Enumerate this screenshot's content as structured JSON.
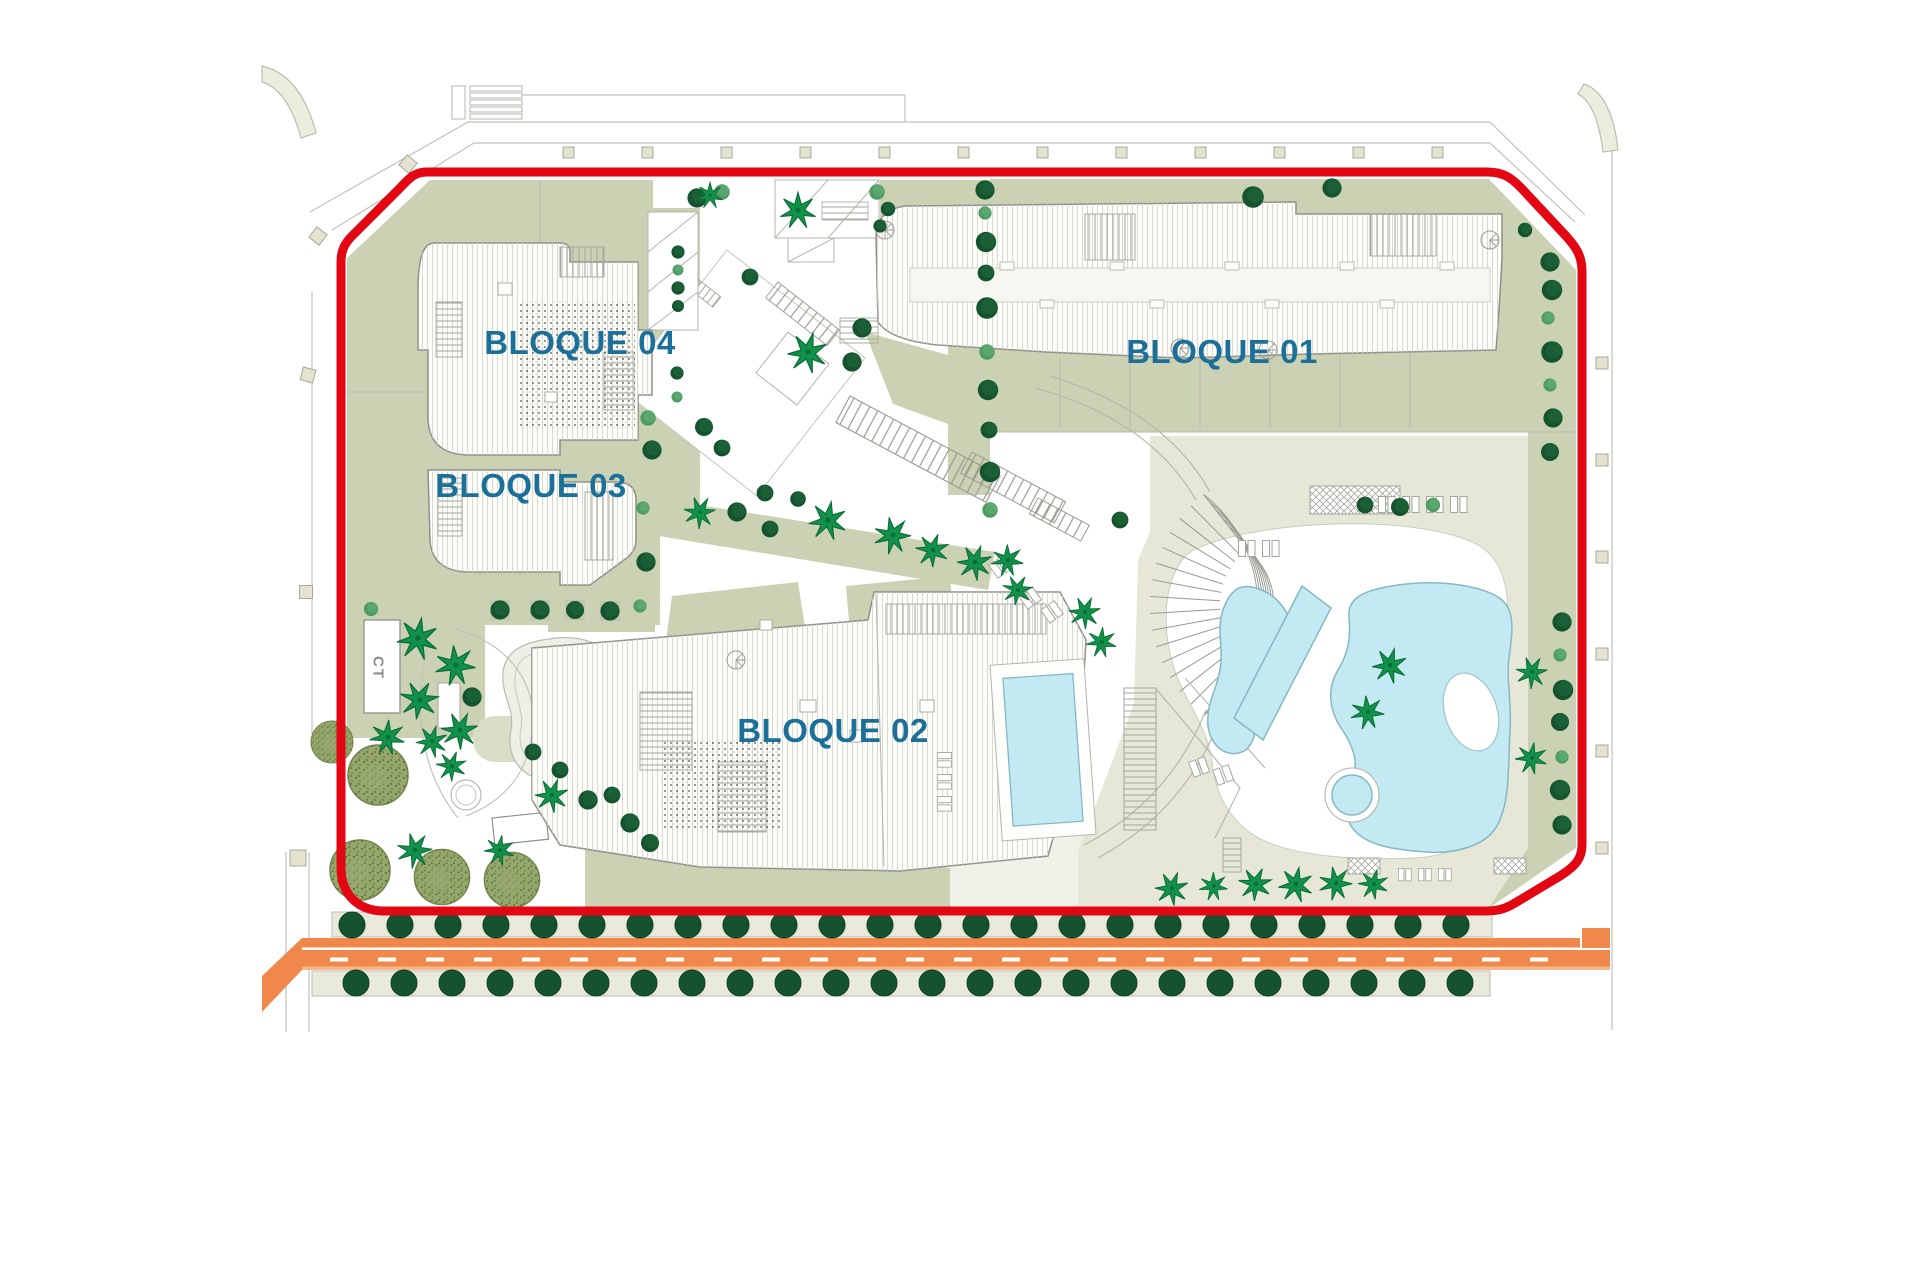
{
  "plan": {
    "block_labels": [
      "BLOQUE 01",
      "BLOQUE 02",
      "BLOQUE 03",
      "BLOQUE 04"
    ],
    "ct_label": "CT"
  },
  "colors": {
    "boundary_red": "#e30613",
    "label_blue": "#1b6f99",
    "sage_green": "#cbd1b3",
    "deck_beige": "#e6e7d7",
    "verge_beige": "#e9e9dc",
    "road_orange": "#f0884c",
    "road_orange_light": "#f7b68c",
    "pool_cyan": "#c3e9f2",
    "tree_dark": "#14532d",
    "tree_medium": "#4f9b64",
    "palm_green": "#12914a",
    "line_gray": "#8f8f8c"
  },
  "render": {
    "road_trees_top": {
      "y": 925,
      "x_start": 352,
      "step": 48,
      "count": 24,
      "r": 13
    },
    "road_trees_bottom": {
      "y": 983,
      "x_start": 356,
      "step": 48,
      "count": 24,
      "r": 13
    },
    "road_dashes": {
      "y": 957.5,
      "x_start": 330,
      "step": 48,
      "count": 26,
      "w": 18,
      "h": 4
    },
    "amphitheater": {
      "cx": 1290,
      "cy": 605,
      "r_min": 70,
      "r_max": 140,
      "rings": 8,
      "a_start": 128,
      "a_end": 232,
      "spokes": 15
    },
    "bollards_top": {
      "x_start": 563,
      "step": 79,
      "count": 12,
      "y": 147,
      "size": 11
    },
    "bollards_right": {
      "x": 1596,
      "y_start": 357,
      "step": 97,
      "count": 6,
      "size": 12
    }
  }
}
